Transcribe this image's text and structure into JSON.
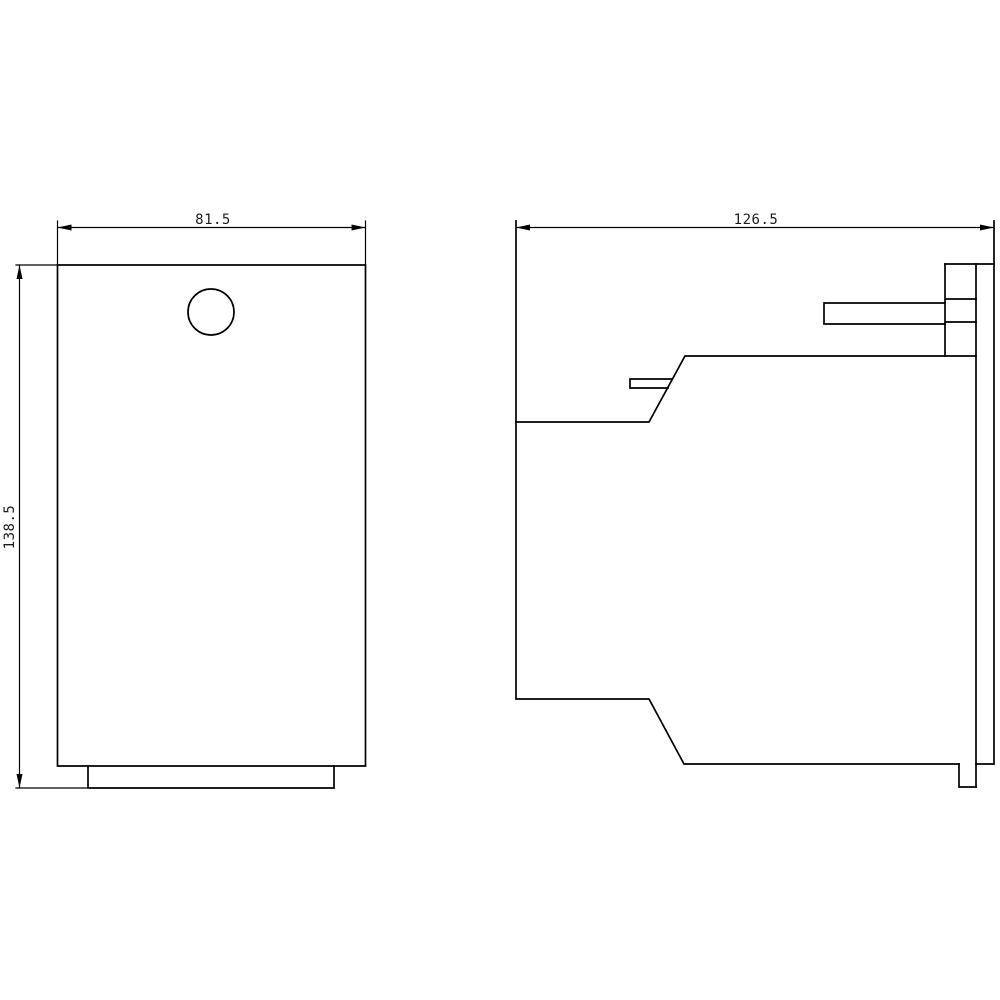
{
  "figure": {
    "background_color": "#ffffff",
    "line_color": "#000000",
    "text_color": "#1c1c1c",
    "views": {
      "front": {
        "width_dim": {
          "label": "81.5"
        },
        "height_dim": {
          "label": "138.5"
        }
      },
      "side": {
        "depth_dim": {
          "label": "126.5"
        }
      }
    }
  }
}
